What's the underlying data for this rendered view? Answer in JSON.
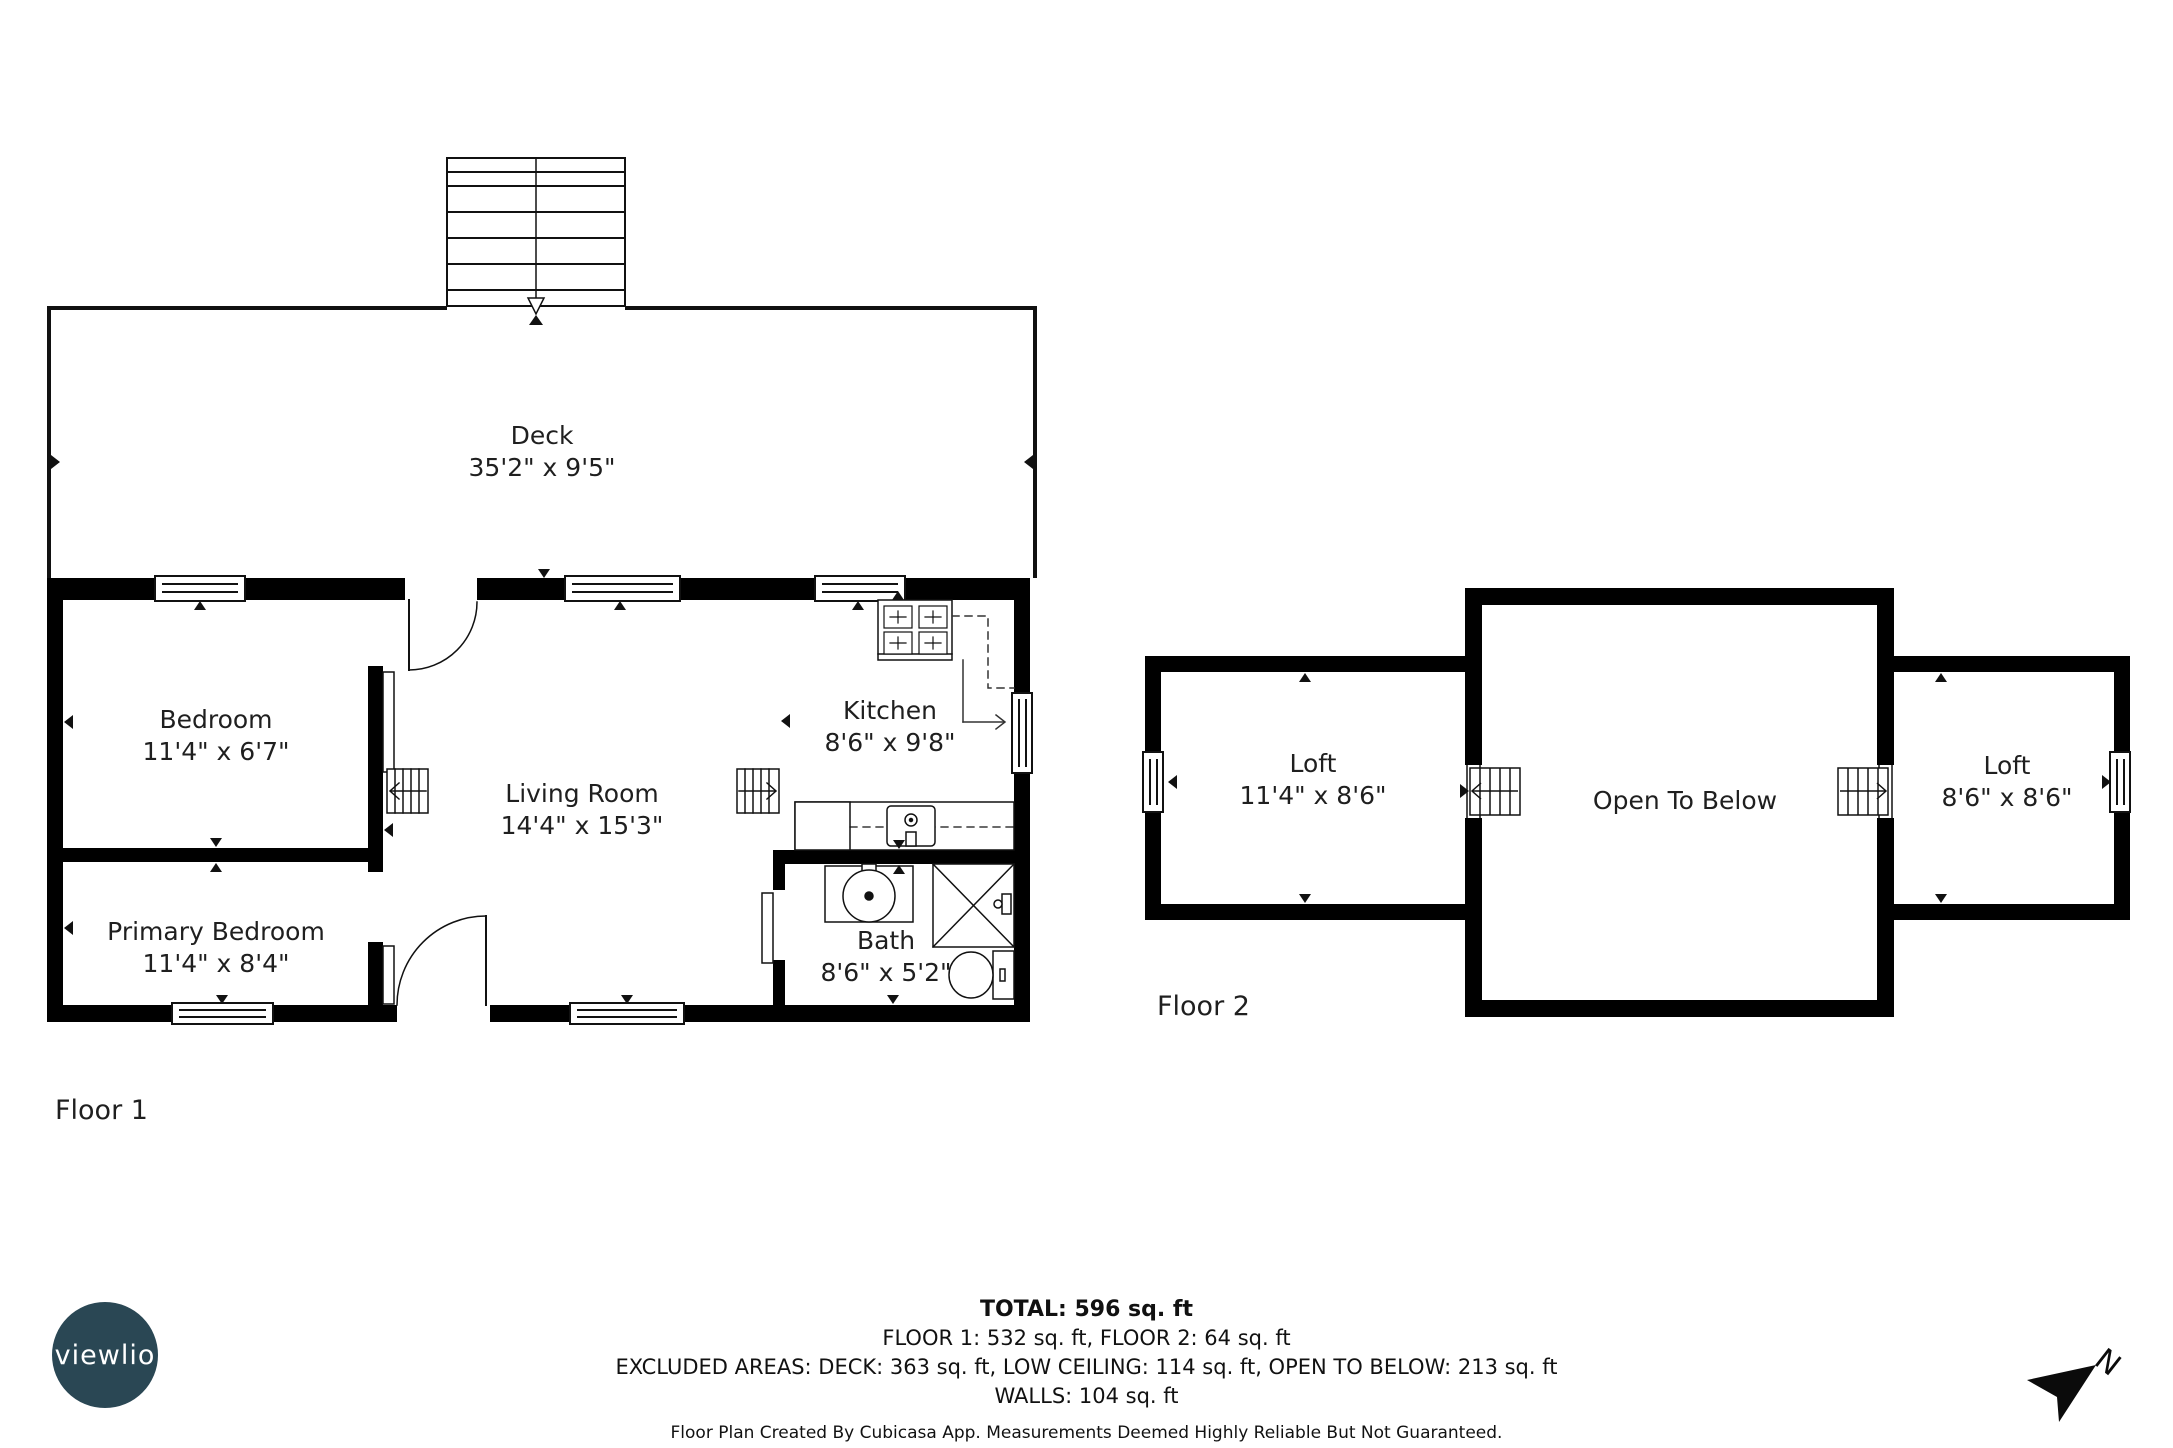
{
  "floors": {
    "floor1": {
      "label": "Floor 1",
      "deck": {
        "name": "Deck",
        "dims": "35'2\" x 9'5\""
      },
      "bedroom": {
        "name": "Bedroom",
        "dims": "11'4\" x 6'7\""
      },
      "primary_bedroom": {
        "name": "Primary Bedroom",
        "dims": "11'4\" x 8'4\""
      },
      "living_room": {
        "name": "Living Room",
        "dims": "14'4\" x 15'3\""
      },
      "kitchen": {
        "name": "Kitchen",
        "dims": "8'6\" x 9'8\""
      },
      "bath": {
        "name": "Bath",
        "dims": "8'6\" x 5'2\""
      }
    },
    "floor2": {
      "label": "Floor 2",
      "loft_left": {
        "name": "Loft",
        "dims": "11'4\" x 8'6\""
      },
      "open_to_below": {
        "name": "Open To Below"
      },
      "loft_right": {
        "name": "Loft",
        "dims": "8'6\" x 8'6\""
      }
    }
  },
  "summary": {
    "total": "TOTAL: 596 sq. ft",
    "floors_line": "FLOOR 1: 532 sq. ft, FLOOR 2: 64 sq. ft",
    "excluded_line": "EXCLUDED AREAS: DECK: 363 sq. ft, LOW CEILING: 114 sq. ft, OPEN TO BELOW: 213 sq. ft",
    "walls_line": "WALLS: 104 sq. ft",
    "disclaimer": "Floor Plan Created By Cubicasa App. Measurements Deemed Highly Reliable But Not Guaranteed."
  },
  "logo": {
    "text": "viewlio",
    "color": "#2a4754"
  },
  "compass": {
    "label": "N"
  }
}
